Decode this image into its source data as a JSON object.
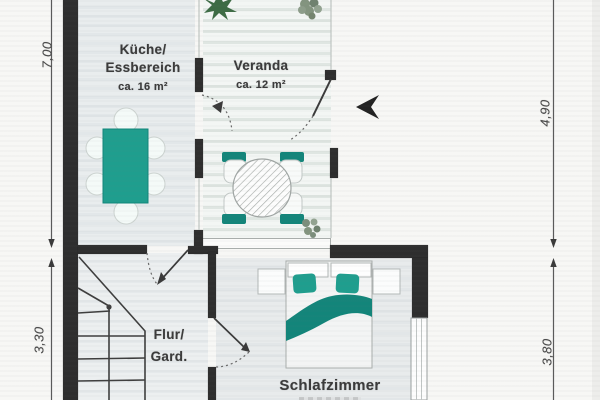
{
  "document": {
    "kind": "apartment floor plan (scanned)"
  },
  "rooms": {
    "kitchen": {
      "name_line1": "Küche/",
      "name_line2": "Essbereich",
      "area": "ca. 16 m²"
    },
    "veranda": {
      "name": "Veranda",
      "area": "ca. 12 m²"
    },
    "hallway": {
      "name_line1": "Flur/",
      "name_line2": "Gard."
    },
    "bedroom": {
      "name": "Schlafzimmer"
    }
  },
  "dimensions": {
    "left_upper": "7,00",
    "left_lower": "3,30",
    "right_upper": "4,90",
    "right_lower": "3,80"
  },
  "icons": {
    "north_arrow": "direction-arrow",
    "plant_large": "potted-plant",
    "plant_small": "potted-plant",
    "staircase": "stairs",
    "door_swings": "door-swing-arc"
  },
  "colors": {
    "accent_teal": "#1f9e8e",
    "accent_teal_dark": "#13857a",
    "wall": "#2e2e2e",
    "dimension": "#4a4a4a",
    "plant_green": "#3d6b44",
    "plant_gray_green": "#83947f"
  }
}
